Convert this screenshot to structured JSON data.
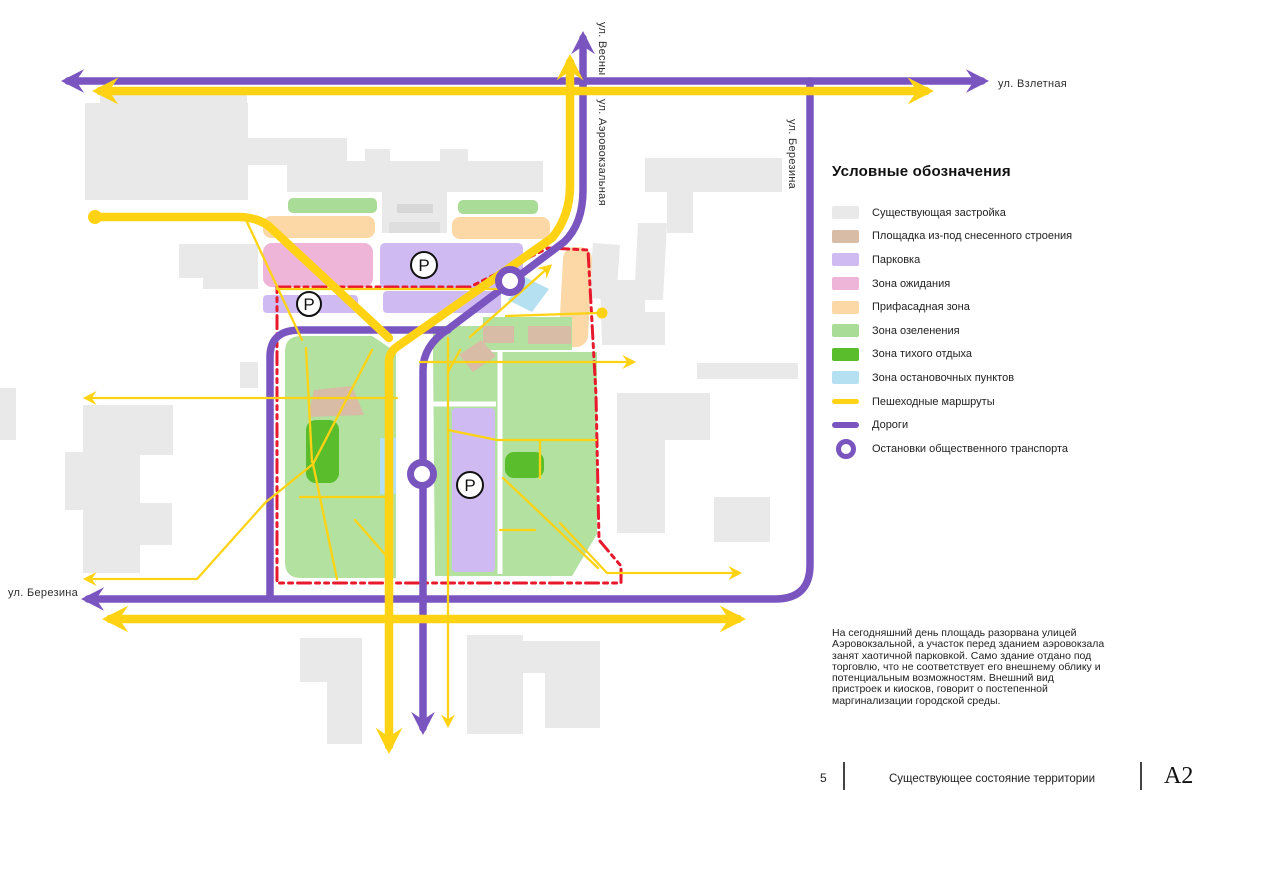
{
  "page": {
    "width": 1267,
    "height": 877,
    "background": "#ffffff"
  },
  "palette": {
    "existing_buildings": "#e9e9e9",
    "demolished_site": "#d8bca6",
    "parking": "#cfbbf2",
    "waiting_zone": "#efb5d8",
    "facade_zone": "#fbd8a5",
    "greenery_zone": "#a9dc96",
    "park_green": "#b3e1a0",
    "quiet_rest_zone": "#5abd2b",
    "stop_points_zone": "#b5e0f2",
    "pedestrian_yellow": "#ffd314",
    "road_purple": "#7a55c0",
    "boundary_red": "#e8192c"
  },
  "map": {
    "streets": {
      "vesny": "ул. Весны",
      "aerovokzalnaya": "ул. Аэровокзальная",
      "berezina_right": "ул. Березина",
      "vzletnaya": "ул. Взлетная",
      "berezina_left": "ул. Березина"
    },
    "parking_letter": "P"
  },
  "legend": {
    "title": "Условные обозначения",
    "items": [
      {
        "label": "Существующая застройка",
        "swatch": "existing",
        "color": "#e9e9e9"
      },
      {
        "label": "Площадка из-под снесенного строения",
        "swatch": "demolished",
        "color": "#d8bca6"
      },
      {
        "label": "Парковка",
        "swatch": "parking",
        "color": "#cfbbf2"
      },
      {
        "label": "Зона ожидания",
        "swatch": "waiting",
        "color": "#efb5d8"
      },
      {
        "label": "Прифасадная зона",
        "swatch": "facade",
        "color": "#fbd8a5"
      },
      {
        "label": "Зона озеленения",
        "swatch": "greenery",
        "color": "#a9dc96"
      },
      {
        "label": "Зона тихого отдыха",
        "swatch": "quiet",
        "color": "#5abd2b"
      },
      {
        "label": "Зона остановочных пунктов",
        "swatch": "stops",
        "color": "#b5e0f2"
      },
      {
        "label": "Пешеходные маршруты",
        "swatch": "line-yellow",
        "color": "#ffd314"
      },
      {
        "label": "Дороги",
        "swatch": "line-purple",
        "color": "#7a55c0"
      },
      {
        "label": "Остановки общественного транспорта",
        "swatch": "ring-purple",
        "color": "#7a55c0"
      }
    ]
  },
  "description": {
    "text": "На сегодняшний день площадь разорвана улицей Аэровокзальной, а участок перед зданием аэровокзала занят хаотичной парковкой. Само здание отдано под торговлю, что не соответствует его внешнему облику и потенциальным возможностям. Внешний вид пристроек и киосков, говорит о постепенной маргинализации городской среды."
  },
  "footer": {
    "page_number": "5",
    "title": "Существующее состояние территории",
    "sheet_format": "А2"
  }
}
